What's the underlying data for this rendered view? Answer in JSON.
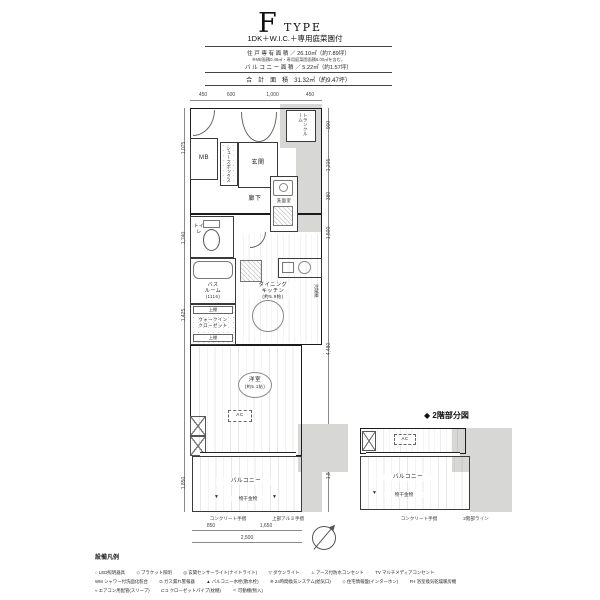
{
  "header": {
    "type_letter": "F",
    "type_word": "TYPE",
    "subtitle": "1DK＋W.I.C.＋専用庭菜園付",
    "area1": "住 戸 専 有 面 積 ／ 26.10㎡（約7.89坪）",
    "note": "※MB面積0.48㎡・専用庭菜園面積6.00㎡を含む。",
    "area2": "バ ル コ ニ ー 面 積 ／ 5.22㎡（約1.57坪）",
    "total": "合　計　面　積　31.32㎡（約9.47坪）"
  },
  "plan": {
    "rooms": {
      "mb": "MB",
      "shoes": "シューズボックス",
      "genkan": "玄関",
      "trunk": "トランクルーム",
      "hall": "廊下",
      "toilet": "トイレ",
      "powder": "洗面室",
      "bath_line1": "バス",
      "bath_line2": "ルーム",
      "bath_size": "(1116)",
      "wic_line1": "ウォークイン",
      "wic_line2": "クローゼット",
      "shelf_top": "上棚",
      "shelf_bottom": "上棚",
      "dk_line1": "ダイニング",
      "dk_line2": "キッチン",
      "dk_size": "(約5.9帖)",
      "fridge": "冷蔵庫",
      "bedroom": "洋室",
      "bedroom_size": "(約5.1帖)",
      "ac": "AC",
      "balcony": "バルコニー",
      "laundry": "物干金物",
      "note_concrete": "コンクリート手摺",
      "note_handrail": "上部アルミ手摺"
    },
    "dims": {
      "top": [
        "450",
        "600",
        "1,000",
        "450"
      ],
      "right": [
        "900",
        "1,215",
        "380",
        "1,500",
        "4,480",
        "1,860"
      ],
      "left": [
        "1,075",
        "1,740",
        "1,425",
        "1,850"
      ],
      "bottom": [
        "850",
        "1,650"
      ],
      "bottom_total": "2,500"
    }
  },
  "second_floor": {
    "title": "◆ 2階部分図",
    "ac": "AC",
    "balcony": "バルコニー",
    "laundry": "物干金物",
    "note_concrete": "コンクリート手摺",
    "note_line": "2階部ライン"
  },
  "legend": {
    "title": "設備凡例",
    "rows": [
      [
        "○ LED照明器具",
        "◇ ブラケット照明",
        "◎ 玄関センサーライト(ナイトライト)",
        "▽ ダウンライト",
        "⊥ アース付防水コンセント",
        "TV マルチメディアコンセント"
      ],
      [
        "WM シャワー付洗面化粧台",
        "G ガス漏れ警報器",
        "▲ バルコニー水栓(散水栓)",
        "※ 24時間換気システム(給気口)",
        "◇ 住宅情報盤(インターホン)",
        "FH 浴室換気乾燥暖房機"
      ],
      [
        "≈ エアコン用配管(スリーブ)",
        "⊏⊐ クローゼットパイプ(枕棚)",
        "＝ 可動棚(物入)"
      ]
    ]
  }
}
